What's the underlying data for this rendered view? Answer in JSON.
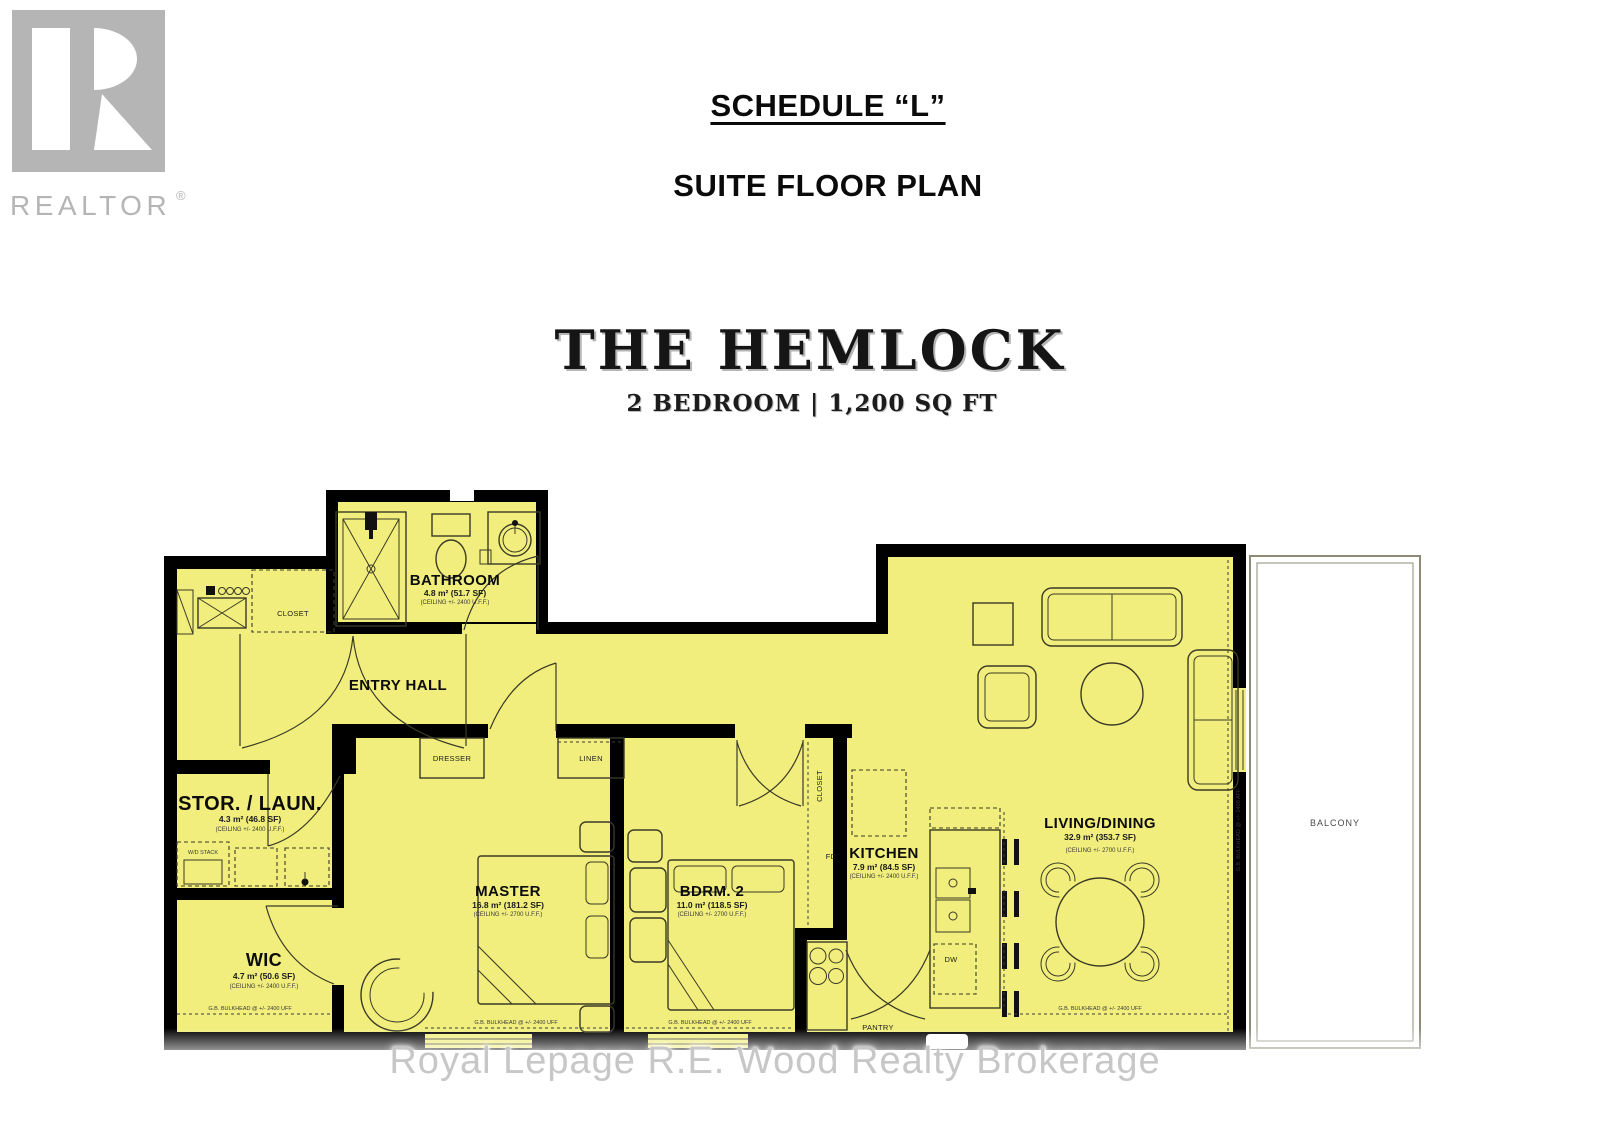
{
  "header": {
    "schedule_title": "SCHEDULE “L”",
    "plan_title": "SUITE FLOOR PLAN"
  },
  "suite": {
    "name": "THE HEMLOCK",
    "spec": "2 BEDROOM  |  1,200 SQ FT"
  },
  "branding": {
    "realtor_text": "REALTOR",
    "registered": "®",
    "watermark": "Royal Lepage R.E. Wood Realty Brokerage"
  },
  "rooms": {
    "bathroom": {
      "name": "BATHROOM",
      "area": "4.8 m² (51.7 SF)",
      "ceiling": "(CEILING +/- 2400 U.F.F.)"
    },
    "entry_hall": {
      "name": "ENTRY HALL"
    },
    "entry_closet": {
      "name": "CLOSET"
    },
    "stor_laun": {
      "name": "STOR. / LAUN.",
      "area": "4.3 m² (46.8 SF)",
      "ceiling": "(CEILING +/- 2400 U.F.F.)"
    },
    "wic": {
      "name": "WIC",
      "area": "4.7 m² (50.6 SF)",
      "ceiling": "(CEILING +/- 2400 U.F.F.)"
    },
    "master": {
      "name": "MASTER",
      "area": "16.8 m² (181.2 SF)",
      "ceiling": "(CEILING +/- 2700 U.F.F.)"
    },
    "bdrm2": {
      "name": "BDRM. 2",
      "area": "11.0 m² (118.5 SF)",
      "ceiling": "(CEILING +/- 2700 U.F.F.)"
    },
    "kitchen": {
      "name": "KITCHEN",
      "area": "7.9 m² (84.5 SF)",
      "ceiling": "(CEILING +/- 2400 U.F.F.)"
    },
    "living_dining": {
      "name": "LIVING/DINING",
      "area": "32.9 m² (353.7 SF)",
      "ceiling": "(CEILING +/- 2700 U.F.F.)"
    },
    "balcony": {
      "name": "BALCONY"
    }
  },
  "fixtures": {
    "dresser": "DRESSER",
    "linen": "LINEN",
    "bdrm2_closet": "CLOSET",
    "wd_stack": "W/D STACK",
    "pantry": "PANTRY",
    "dishwasher": "DW",
    "fridge": "FD"
  },
  "notes": {
    "bulkhead": "G.B. BULKHEAD @ +/- 2400 UFF",
    "bulkhead_vertical": "G.B. BULKHEAD @ +/- 2400 AFF"
  },
  "colors": {
    "plan_fill": "#f1ee7d",
    "wall": "#000000",
    "logo_gray": "#b5b5b5",
    "watermark_gray": "#c7c7c7"
  }
}
